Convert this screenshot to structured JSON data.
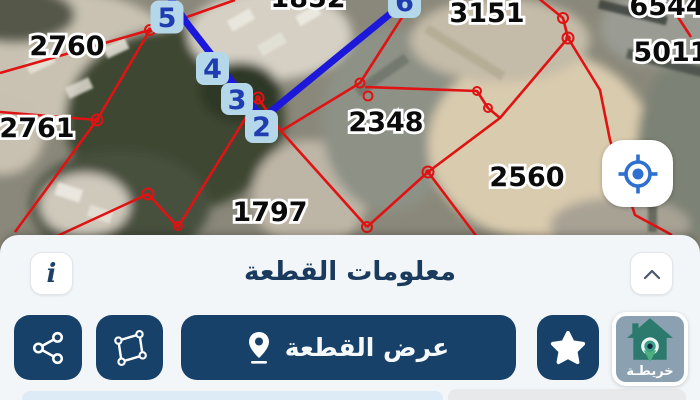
{
  "map": {
    "parcel_labels": [
      {
        "text": "2760"
      },
      {
        "text": "2761"
      },
      {
        "text": "1852"
      },
      {
        "text": "3151"
      },
      {
        "text": "6544"
      },
      {
        "text": "5011"
      },
      {
        "text": "2348"
      },
      {
        "text": "2560"
      },
      {
        "text": "1797"
      }
    ],
    "vertex_markers": [
      {
        "label": "5"
      },
      {
        "label": "4"
      },
      {
        "label": "3"
      },
      {
        "label": "2"
      },
      {
        "label": "6"
      }
    ],
    "colors": {
      "parcel_line": "#df1313",
      "selection_line": "#1b18dc",
      "vertex_chip_bg": "#b5d7ea",
      "vertex_chip_text": "#1f3db0",
      "locate_icon": "#2e6fd0",
      "action_navy": "#174169"
    }
  },
  "panel": {
    "title": "معلومات القطعة",
    "info_glyph": "i",
    "actions": {
      "view_parcel_label": "عرض القطعة",
      "icons": [
        "share-icon",
        "polygon-icon",
        "location-pin-icon",
        "star-icon",
        "chevron-up-icon",
        "info-icon"
      ]
    },
    "logo_text": "خريطـة"
  }
}
